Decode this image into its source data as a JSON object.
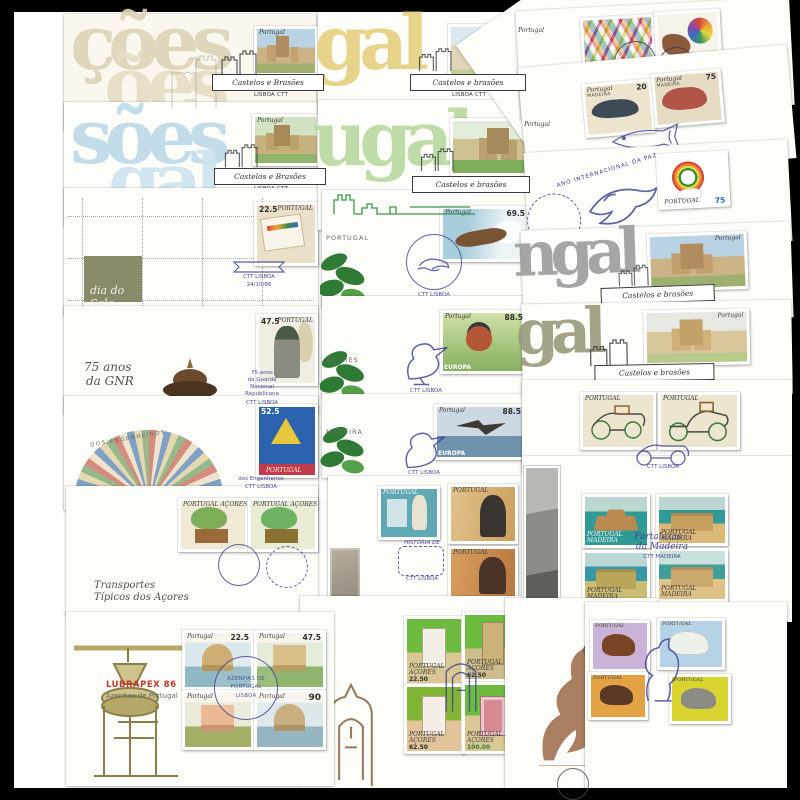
{
  "artwork": {
    "description": "Collage of Portuguese first day covers with stamps and postmarks on a black-framed board"
  },
  "palette": {
    "frame": "#000000",
    "mat": "#ffffff",
    "cover": "#fdfdfa",
    "postmark_blue": "#3c3f92",
    "postmark_black": "#3a3a3e",
    "accent_red": "#c0392b",
    "watermark_beige": "#ddd3b6",
    "watermark_blue": "#bcd9e8",
    "watermark_yellow": "#e6cf7e",
    "watermark_green": "#b8d9a0",
    "watermark_grey": "#9c9c9a",
    "watermark_olive": "#9a9a7c"
  },
  "covers": {
    "c01": {
      "watermark_a": "ções",
      "watermark_b": "ões",
      "stamp": {
        "country": "Portugal"
      },
      "postmark": {
        "title": "Castelos e Brasões",
        "sub": "LISBOA CTT"
      }
    },
    "c02": {
      "watermark_a": "sões",
      "watermark_b": "gal",
      "stamp": {
        "country": "Portugal"
      },
      "postmark": {
        "title": "Castelos e Brasões",
        "sub": "LISBOA CTT"
      }
    },
    "c03": {
      "panel_label": "dia do Selo",
      "stamp": {
        "country": "PORTUGAL",
        "value": "22.5"
      },
      "postmark": {
        "line1": "CTT LISBOA",
        "line2": "24/10/86"
      }
    },
    "c04": {
      "caption_line1": "75 anos",
      "caption_line2": "da GNR",
      "stamp": {
        "country": "PORTUGAL",
        "value": "47.5"
      },
      "postmark": {
        "line1": "75 anos",
        "line2": "da Guarda",
        "line3": "Nacional",
        "line4": "Republicana",
        "sub": "CTT LISBOA"
      }
    },
    "c05": {
      "arc_label": "DOS ENGENHEIROS",
      "stamp": {
        "country": "PORTUGAL",
        "value": "52.5"
      },
      "postmark": {
        "line1": "dos Engenheiros",
        "sub": "CTT LISBOA"
      }
    },
    "c06": {
      "caption_line1": "Transportes",
      "caption_line2": "Típicos dos Açores",
      "stamps": [
        {
          "country": "PORTUGAL AÇORES"
        },
        {
          "country": "PORTUGAL AÇORES"
        }
      ]
    },
    "c07": {
      "brand": "LUBRAPEX 86",
      "subtitle": "Azenhas de Portugal",
      "stamps": [
        {
          "country": "Portugal",
          "value": "22.5"
        },
        {
          "country": "Portugal",
          "value": "47.5"
        },
        {
          "country": "Portugal",
          "value": ""
        },
        {
          "country": "Portugal",
          "value": "90"
        }
      ],
      "postmark": {
        "line1": "AZENHAS DE",
        "line2": "PORTUGAL",
        "line3": "LISBOA"
      }
    },
    "c08": {
      "watermark_a": "gal",
      "stamp": {
        "country": "Portugal"
      },
      "postmark": {
        "title": "Castelos e brasões",
        "sub": "LISBOA CTT"
      }
    },
    "c09": {
      "watermark_a": "ugal",
      "stamp": {
        "country": "Portugal"
      },
      "postmark": {
        "title": "Castelos e brasões",
        "sub": "LISBOA CTT 10.4.86"
      }
    },
    "c10": {
      "edge_label": "PORTUGAL",
      "stamp": {
        "country": "Portugal",
        "value": "69.5"
      },
      "postmark": {
        "sub": "CTT LISBOA"
      }
    },
    "c11": {
      "edge_label": "AÇORES",
      "stamp": {
        "country": "Portugal",
        "value": "88.5",
        "series": "EUROPA"
      },
      "postmark": {
        "sub": "CTT LISBOA"
      }
    },
    "c12": {
      "edge_label": "MADEIRA",
      "stamp": {
        "country": "Portugal",
        "value": "88.5",
        "series": "EUROPA"
      },
      "postmark": {
        "sub": "CTT LISBOA"
      }
    },
    "c13": {
      "stamps": [
        {
          "country": "PORTUGAL"
        },
        {
          "country": "PORTUGAL"
        },
        {
          "country": "PORTUGAL"
        }
      ],
      "postmark": {
        "line1": "HISTÓRIA DE",
        "sub": "CTT LISBOA"
      }
    },
    "c14": {
      "stamps": [
        {
          "country": "PORTUGAL AÇORES",
          "value": "22.50"
        },
        {
          "country": "PORTUGAL AÇORES",
          "value": "62.50"
        },
        {
          "country": "PORTUGAL AÇORES",
          "value": "62.50"
        },
        {
          "country": "PORTUGAL AÇORES",
          "value": "100.00"
        }
      ]
    },
    "c15": {},
    "c16": {
      "stamps": [
        {
          "country": "PORTUGAL"
        },
        {
          "country": "PORTUGAL"
        },
        {
          "country": "PORTUGAL"
        },
        {
          "country": "PORTUGAL"
        }
      ]
    },
    "c17": {
      "diagonal_label": "PORTUGAL",
      "postmark": {
        "line1": "PORTUGAL",
        "line2": "86"
      }
    },
    "c18": {
      "diagonal_label": "PORTUGAL",
      "postmark": {
        "date": "7/1/86"
      }
    },
    "c19": {
      "stamps": [
        {
          "country": "Portugal",
          "region": "MADEIRA",
          "value": "20"
        },
        {
          "country": "Portugal",
          "region": "MADEIRA",
          "value": "75"
        }
      ],
      "postmark": {
        "line1": "ESPÉCIES MARINHAS",
        "line2": "DA MADEIRA"
      }
    },
    "c20": {
      "arc_label": "ANO INTERNACIONAL DA PAZ",
      "stamp": {
        "country": "PORTUGAL",
        "value": "75"
      }
    },
    "c21": {
      "watermark_a": "ngal",
      "stamp": {
        "country": "Portugal"
      },
      "postmark": {
        "title": "Castelos e brasões",
        "sub": "LISBOA CTT"
      }
    },
    "c22": {
      "watermark_a": "gal",
      "stamp": {
        "country": "Portugal"
      },
      "postmark": {
        "title": "Castelos e brasões",
        "sub": "LISBOA CTT"
      }
    },
    "c23": {
      "stamps": [
        {
          "country": "PORTUGAL"
        },
        {
          "country": "PORTUGAL"
        }
      ],
      "postmark": {
        "sub": "CTT LISBOA"
      }
    },
    "c24": {
      "stamps": [
        {
          "country": "PORTUGAL MADEIRA"
        },
        {
          "country": "PORTUGAL MADEIRA"
        },
        {
          "country": "PORTUGAL MADEIRA"
        },
        {
          "country": "PORTUGAL MADEIRA"
        }
      ],
      "postmark": {
        "line1": "Fortalezas",
        "line2": "da Madeira",
        "sub": "CTT MADEIRA"
      }
    }
  }
}
